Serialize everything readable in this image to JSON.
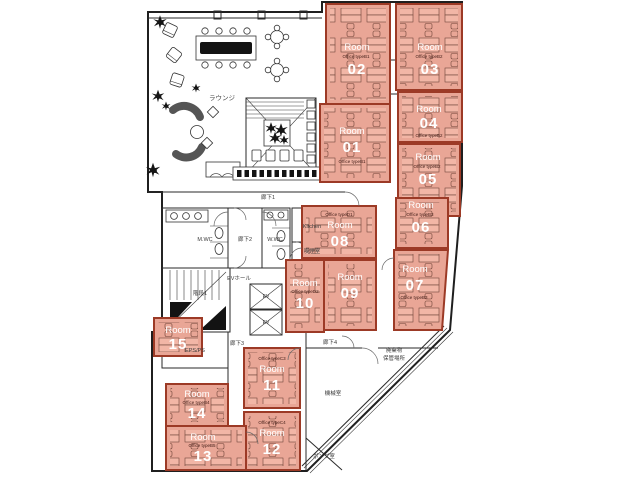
{
  "colors": {
    "room_fill": "#e9a696",
    "room_border": "#9c3a26",
    "wall": "#1f1f1f",
    "room_text": "#ffffff",
    "annotation_text": "#3a3a3a"
  },
  "rooms": [
    {
      "label": "Room",
      "number": "01",
      "type": "Office typeB1"
    },
    {
      "label": "Room",
      "number": "02",
      "type": "Office typeB1"
    },
    {
      "label": "Room",
      "number": "03",
      "type": "Office typeB2"
    },
    {
      "label": "Room",
      "number": "04",
      "type": "Office typeB2"
    },
    {
      "label": "Room",
      "number": "05",
      "type": "Office typeB2"
    },
    {
      "label": "Room",
      "number": "06",
      "type": "Office typeB3"
    },
    {
      "label": "Room",
      "number": "07",
      "type": "Office typeB3"
    },
    {
      "label": "Room",
      "number": "08",
      "type": "Office typeD1"
    },
    {
      "label": "Room",
      "number": "09",
      "type": ""
    },
    {
      "label": "Room",
      "number": "10",
      "type": "Office typeD2"
    },
    {
      "label": "Room",
      "number": "11",
      "type": "Office typeC3"
    },
    {
      "label": "Room",
      "number": "12",
      "type": "Office typeC4"
    },
    {
      "label": "Room",
      "number": "13",
      "type": "Office typeB5"
    },
    {
      "label": "Room",
      "number": "14",
      "type": "Office typeB4"
    },
    {
      "label": "Room",
      "number": "15",
      "type": ""
    }
  ],
  "areas": {
    "lounge": "ラウンジ",
    "corridor1": "廊下1",
    "corridor2": "廊下2",
    "corridor3": "廊下3",
    "corridor4": "廊下4",
    "mens_wc": "M.WC",
    "womens_wc": "W.WC",
    "kitchen": "Kitchen",
    "smoking_room": "喫煙室",
    "stairs1": "階段1",
    "elevator_hall": "EVホール",
    "elevator": "EV",
    "eps_ps": "EPS/PS",
    "machine_room": "機械室",
    "pump_room": "ポンプ室",
    "waste_line1": "廃棄物",
    "waste_line2": "保管場所"
  }
}
